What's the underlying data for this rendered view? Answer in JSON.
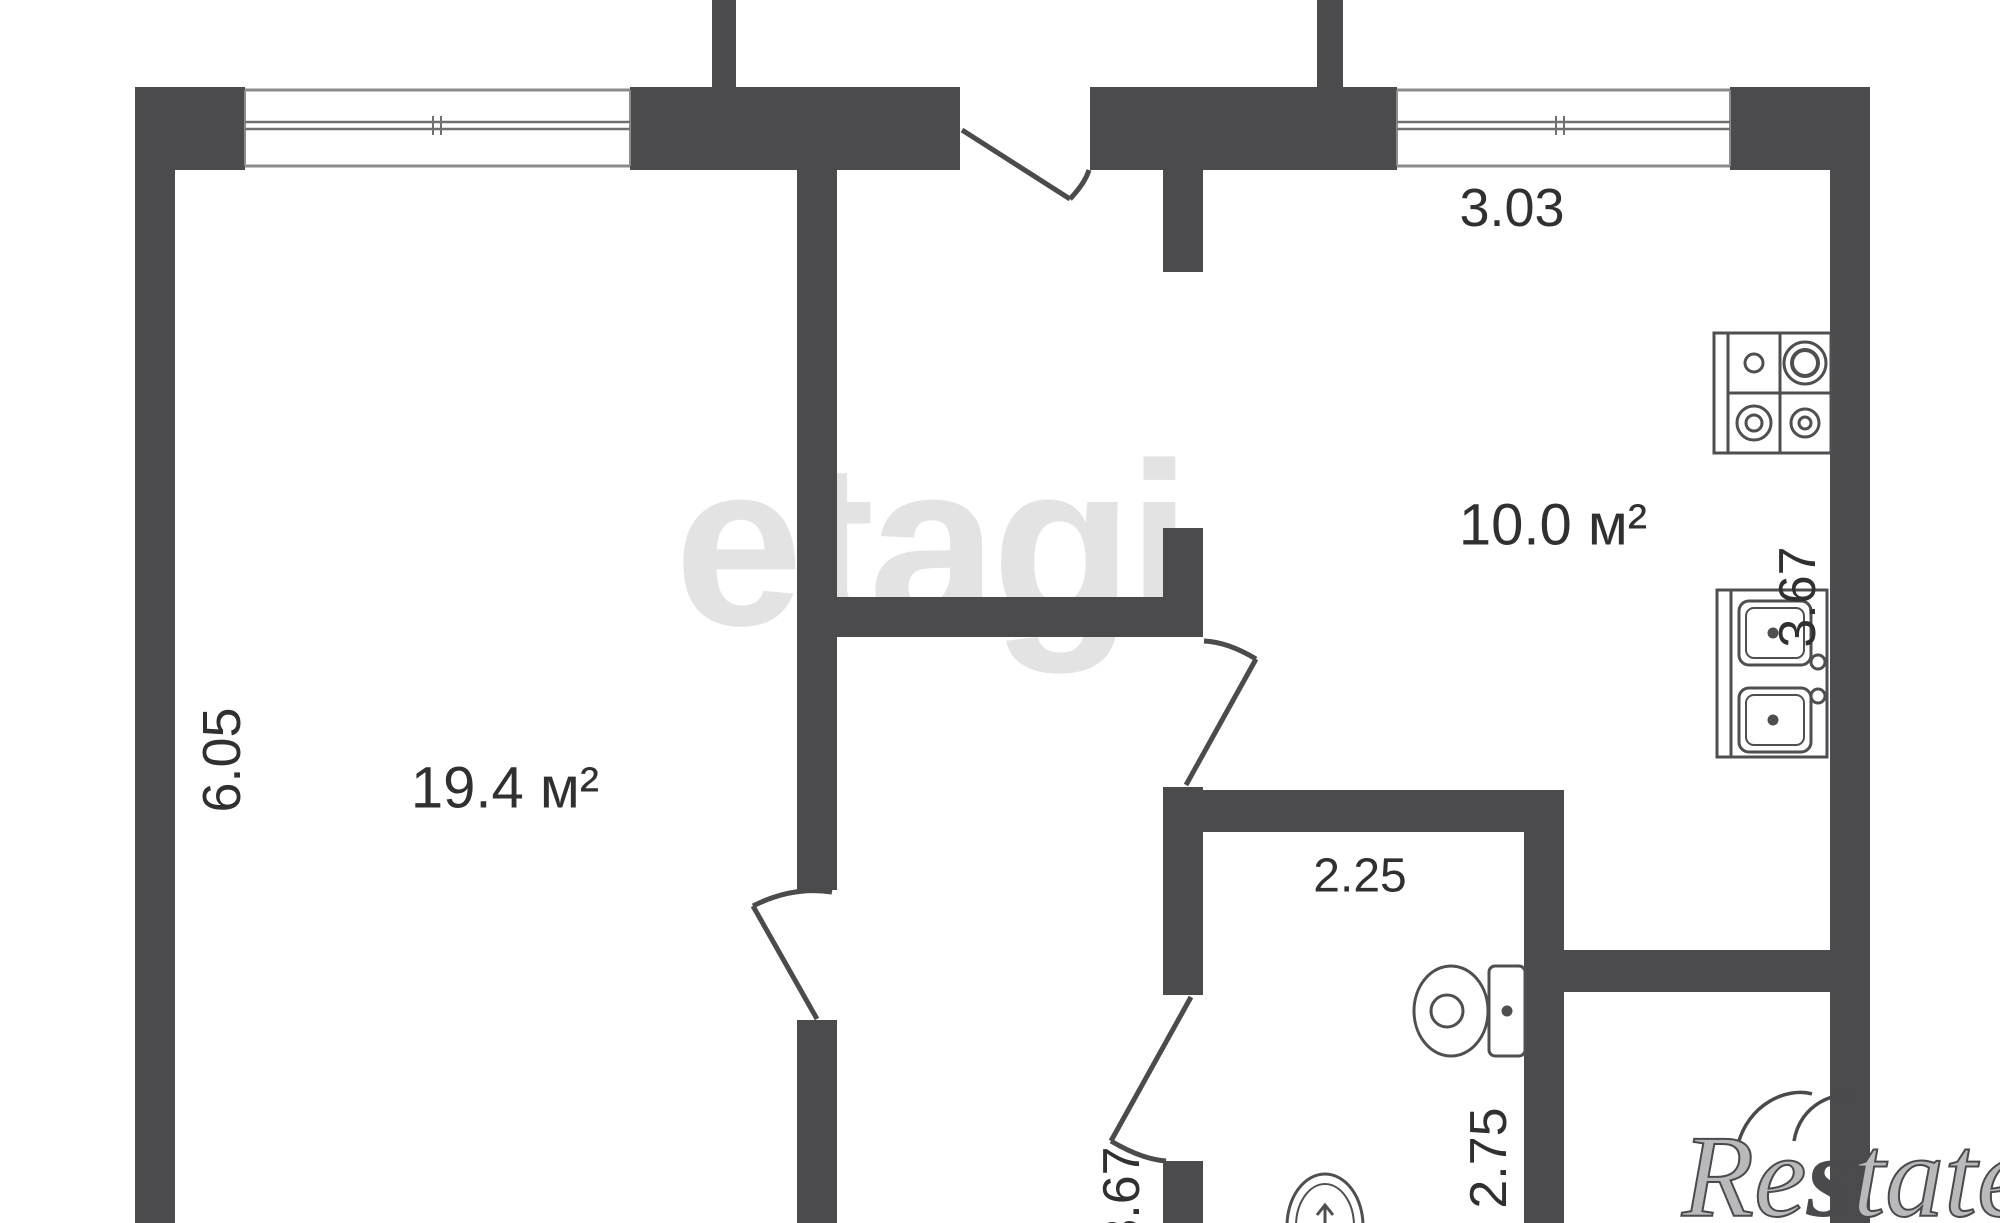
{
  "title": "apartment-floor-plan",
  "colors": {
    "wall": "#4b4b4d",
    "dim_text": "#303032",
    "fixture_stroke": "#4f4f52",
    "window_line": "#8c8c8c",
    "watermark_center": "#e3e3e3",
    "watermark_corner": "#4a4a4c"
  },
  "rooms": {
    "living": {
      "area": "19.4 м²",
      "side": "6.05"
    },
    "kitchen": {
      "area": "10.0 м²",
      "top": "3.03",
      "side": "3.67"
    },
    "bathroom": {
      "top": "2.25",
      "side": "2.75"
    },
    "corridor": {
      "side": "3.67"
    }
  },
  "watermarks": {
    "center": "etagi",
    "corner_parts": [
      "Re",
      "s",
      "tate"
    ]
  },
  "fixtures": [
    "stove-icon",
    "sink-icon",
    "toilet-icon",
    "washbasin-icon"
  ]
}
